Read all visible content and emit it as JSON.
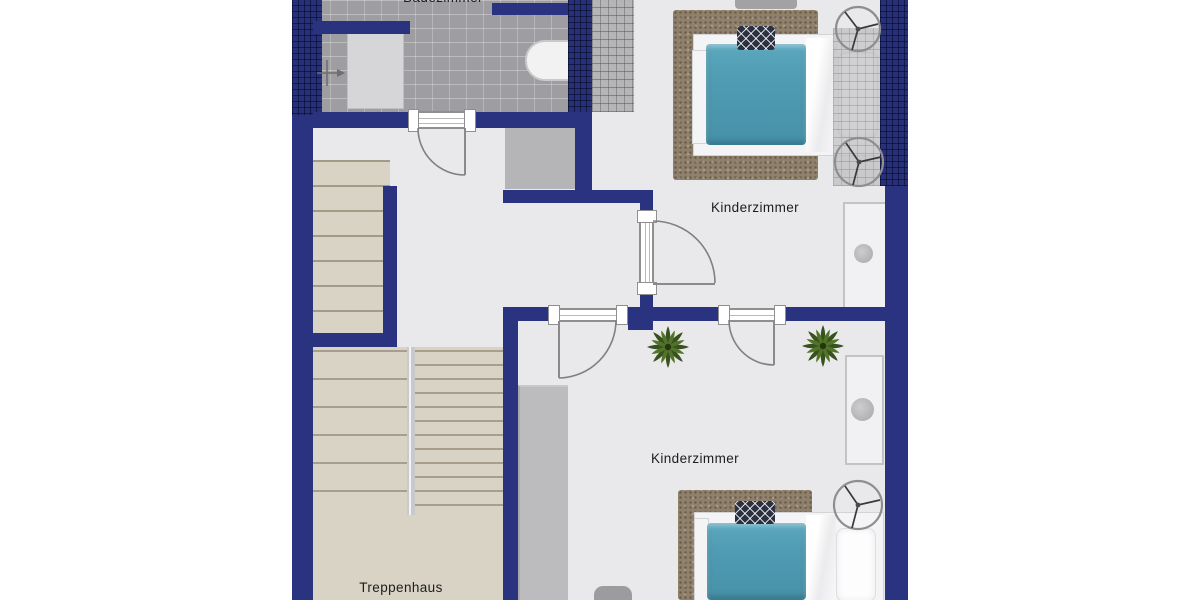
{
  "floorplan": {
    "type": "attic-floor-plan",
    "rooms": {
      "bathroom": {
        "label": "Badezimmer"
      },
      "children_room_top": {
        "label": "Kinderzimmer"
      },
      "children_room_bottom": {
        "label": "Kinderzimmer"
      },
      "staircase": {
        "label": "Treppenhaus"
      }
    },
    "palette": {
      "wall_navy": "#293380",
      "roof_hatch_navy": "#273079",
      "roof_shingle_gray": "#b5b5b7",
      "floor_light": "#e9e9eb",
      "bathroom_tile": "#9e9ea2",
      "stairs_beige": "#d9d3c5",
      "rug_brown": "#8f806b",
      "bed_blanket_teal": "#4f9cb3",
      "plant_green": "#45652b",
      "furniture_white": "#f4f4f6"
    },
    "icons": {
      "ceiling_fan": "ceiling-fan-icon",
      "plant": "plant-icon",
      "shower_head": "shower-head-icon"
    }
  }
}
